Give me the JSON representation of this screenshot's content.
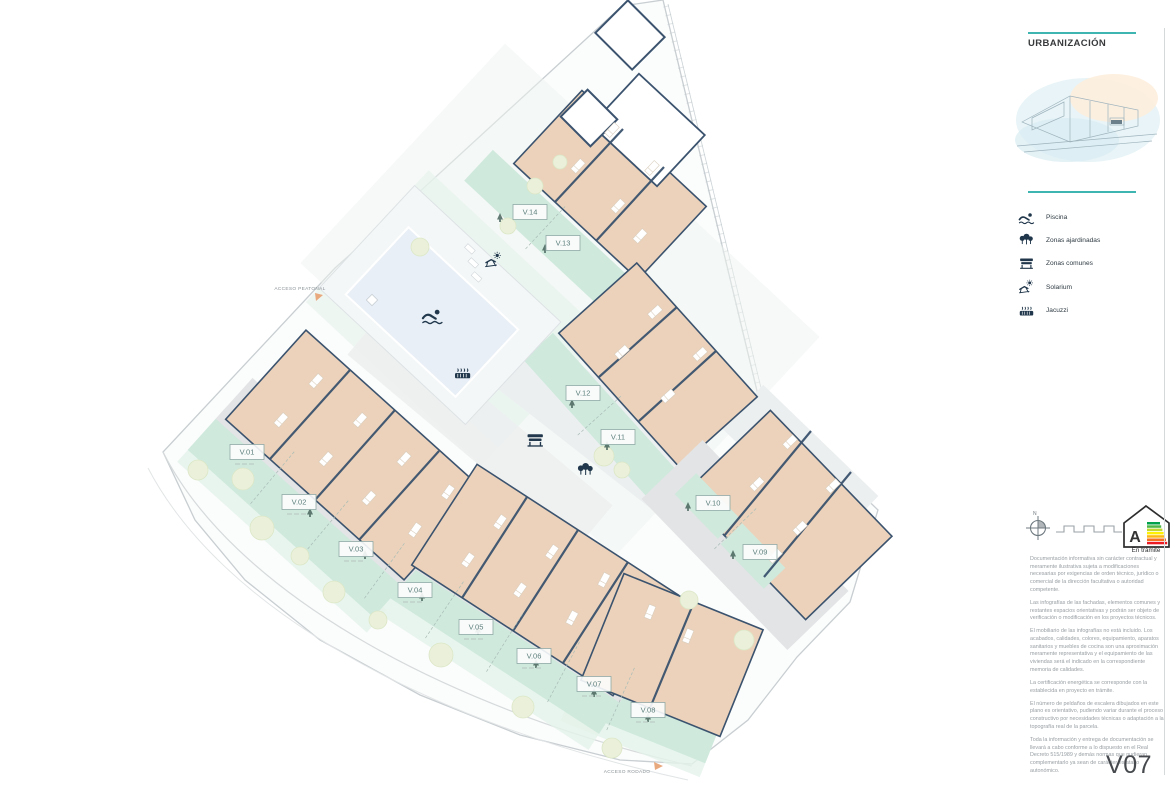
{
  "plan": {
    "units": [
      {
        "label": "V.01"
      },
      {
        "label": "V.02"
      },
      {
        "label": "V.03"
      },
      {
        "label": "V.04"
      },
      {
        "label": "V.05"
      },
      {
        "label": "V.06"
      },
      {
        "label": "V.07"
      },
      {
        "label": "V.08"
      },
      {
        "label": "V.09"
      },
      {
        "label": "V.10"
      },
      {
        "label": "V.11"
      },
      {
        "label": "V.12"
      },
      {
        "label": "V.13"
      },
      {
        "label": "V.14"
      }
    ],
    "access": {
      "pedestrian": "ACCESO PEATONAL",
      "road": "ACCESO RODADO"
    },
    "compass_north": "N",
    "map_icons": [
      "swimmer-icon",
      "jacuzzi-icon",
      "solarium-icon",
      "bench-icon",
      "trees-icon"
    ]
  },
  "panel": {
    "title": "URBANIZACIÓN",
    "legend": [
      {
        "icon": "swimmer-icon",
        "label": "Piscina"
      },
      {
        "icon": "trees-icon",
        "label": "Zonas ajardinadas"
      },
      {
        "icon": "bench-icon",
        "label": "Zonas comunes"
      },
      {
        "icon": "solarium-icon",
        "label": "Solarium"
      },
      {
        "icon": "jacuzzi-icon",
        "label": "Jacuzzi"
      }
    ],
    "energy": {
      "letter": "A",
      "status": "En trámite",
      "stripe_colors": [
        "#00a14b",
        "#4db748",
        "#bfd630",
        "#fff101",
        "#fdb913",
        "#f36f21",
        "#ed1c24"
      ]
    },
    "disclaimer": [
      "Documentación informativa sin carácter contractual y meramente ilustrativa sujeta a modificaciones necesarias por exigencias de orden técnico, jurídico o comercial de la dirección facultativa o autoridad competente.",
      "Las infografías de las fachadas, elementos comunes y restantes espacios orientativas y podrán ser objeto de verificación o modificación en los proyectos técnicos.",
      "El mobiliario de las infografías no está incluido. Los acabados, calidades, colores, equipamiento, aparatos sanitarios y muebles de cocina son una aproximación meramente representativa y el equipamiento de las viviendas será el indicado en la correspondiente memoria de calidades.",
      "La certificación energética se corresponde con la establecida en proyecto en trámite.",
      "El número de peldaños de escalera dibujados en este plano es orientativo, pudiendo variar durante el proceso constructivo por necesidades técnicas o adaptación a la topografía real de la parcela.",
      "Toda la información y entrega de documentación se llevará a cabo conforme a lo dispuesto en el Real Decreto 515/1989 y demás normas que pudieran complementarlo ya sean de carácter estatal o autonómico."
    ],
    "sheet_code": "V07"
  },
  "colors": {
    "accent_teal": "#3fb5b2",
    "wall_navy": "#3b536e",
    "floor_peach": "#ecd2ba",
    "garden_mint": "#cfe9dd",
    "pool_water": "#e9eff6",
    "path_gray": "#eceef0"
  }
}
